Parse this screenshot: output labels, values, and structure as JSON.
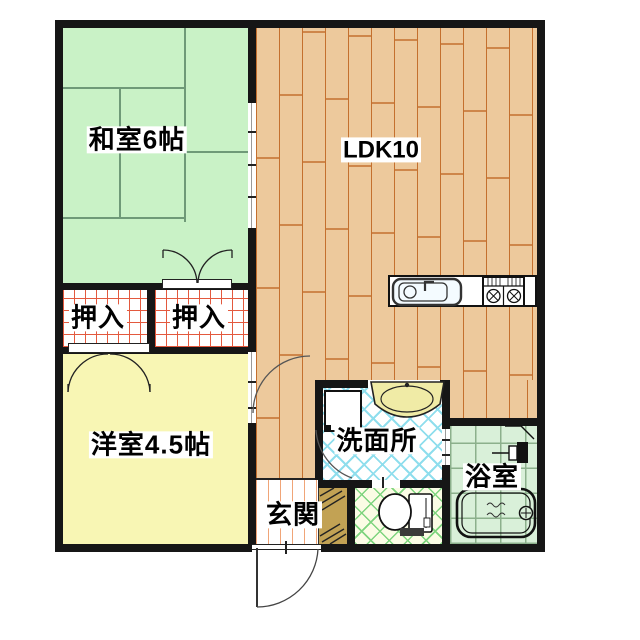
{
  "plan": {
    "type": "apartment-floor-plan",
    "rooms": {
      "washitsu": {
        "label": "和室6帖"
      },
      "ldk": {
        "label": "LDK10"
      },
      "oshiire_left": {
        "label": "押入"
      },
      "oshiire_right": {
        "label": "押入"
      },
      "youshitsu": {
        "label": "洋室4.5帖"
      },
      "senmenjo": {
        "label": "洗面所"
      },
      "genkan": {
        "label": "玄関"
      },
      "yokushitsu": {
        "label": "浴室"
      }
    },
    "fixtures": [
      "kitchen-sink",
      "gas-stove",
      "washing-machine",
      "wash-basin",
      "toilet",
      "bathtub",
      "shower",
      "entrance-door"
    ],
    "colors": {
      "wall": "#161616",
      "tatami-bg": "#c9f2c6",
      "tatami-line": "#6f9a78",
      "wood-bg": "#edc99c",
      "wood-line": "#c4702e",
      "closet-line": "#e3593e",
      "youshitsu-bg": "#f8f6b4",
      "wet-line": "#8fdeed",
      "wc-bg": "#fbfce5",
      "wc-line": "#7ed47e",
      "bath-bg": "#d9f0d9",
      "bath-line": "#8cb08c",
      "genkan-line": "#f0a578",
      "step-bg": "#c2a254",
      "basin-fill": "#f0eba6"
    }
  }
}
